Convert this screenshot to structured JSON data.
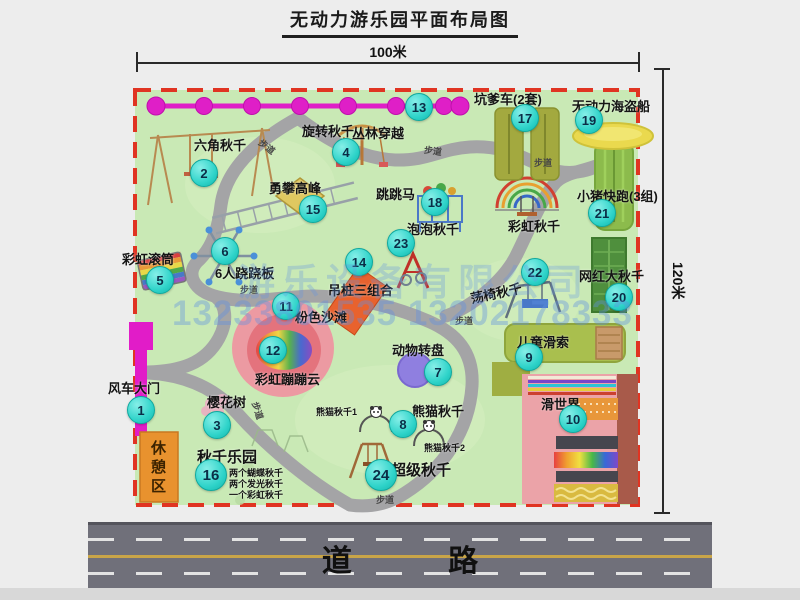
{
  "title": "无动力游乐园平面布局图",
  "dim_top": "100米",
  "dim_right": "120米",
  "road": {
    "label": "道  路"
  },
  "rest_area": "休憩区",
  "walkway_label": "步道",
  "watermark": {
    "company": "游乐设备有限公司",
    "phone": "13233801535 13202178333"
  },
  "notes": {
    "panda1": "熊猫秋千1",
    "panda2": "熊猫秋千2",
    "rainbow_swing": "彩虹秋千",
    "swing_park": [
      "两个蝴蝶秋千",
      "两个发光秋千",
      "一个彩虹秋千"
    ]
  },
  "attractions": [
    {
      "num": "1",
      "name": "风车大门"
    },
    {
      "num": "2",
      "name": "六角秋千"
    },
    {
      "num": "3",
      "name": "樱花树"
    },
    {
      "num": "4",
      "name": "旋转秋千"
    },
    {
      "num": "5",
      "name": "彩虹滚筒"
    },
    {
      "num": "6",
      "name": "6人跷跷板"
    },
    {
      "num": "7",
      "name": "动物转盘"
    },
    {
      "num": "8",
      "name": "熊猫秋千"
    },
    {
      "num": "9",
      "name": "儿童滑索"
    },
    {
      "num": "10",
      "name": "滑世界"
    },
    {
      "num": "11",
      "name": "粉色沙滩"
    },
    {
      "num": "12",
      "name": "彩虹蹦蹦云"
    },
    {
      "num": "13",
      "name": "丛林穿越"
    },
    {
      "num": "14",
      "name": "吊桩三组合"
    },
    {
      "num": "15",
      "name": "勇攀高峰"
    },
    {
      "num": "16",
      "name": "秋千乐园"
    },
    {
      "num": "17",
      "name": "坑爹车(2套)"
    },
    {
      "num": "18",
      "name": "跳跳马"
    },
    {
      "num": "19",
      "name": "无动力海盗船"
    },
    {
      "num": "20",
      "name": "网红大秋千"
    },
    {
      "num": "21",
      "name": "小猪快跑(3组)"
    },
    {
      "num": "22",
      "name": "荡椅秋千"
    },
    {
      "num": "23",
      "name": "泡泡秋千"
    },
    {
      "num": "24",
      "name": "超级秋千"
    }
  ],
  "colors": {
    "map_green": "#c9e9b5",
    "border_red": "#e03422",
    "badge_cyan": "#2ed3c9",
    "magenta": "#df1fc7",
    "road_gray": "#70707a"
  }
}
